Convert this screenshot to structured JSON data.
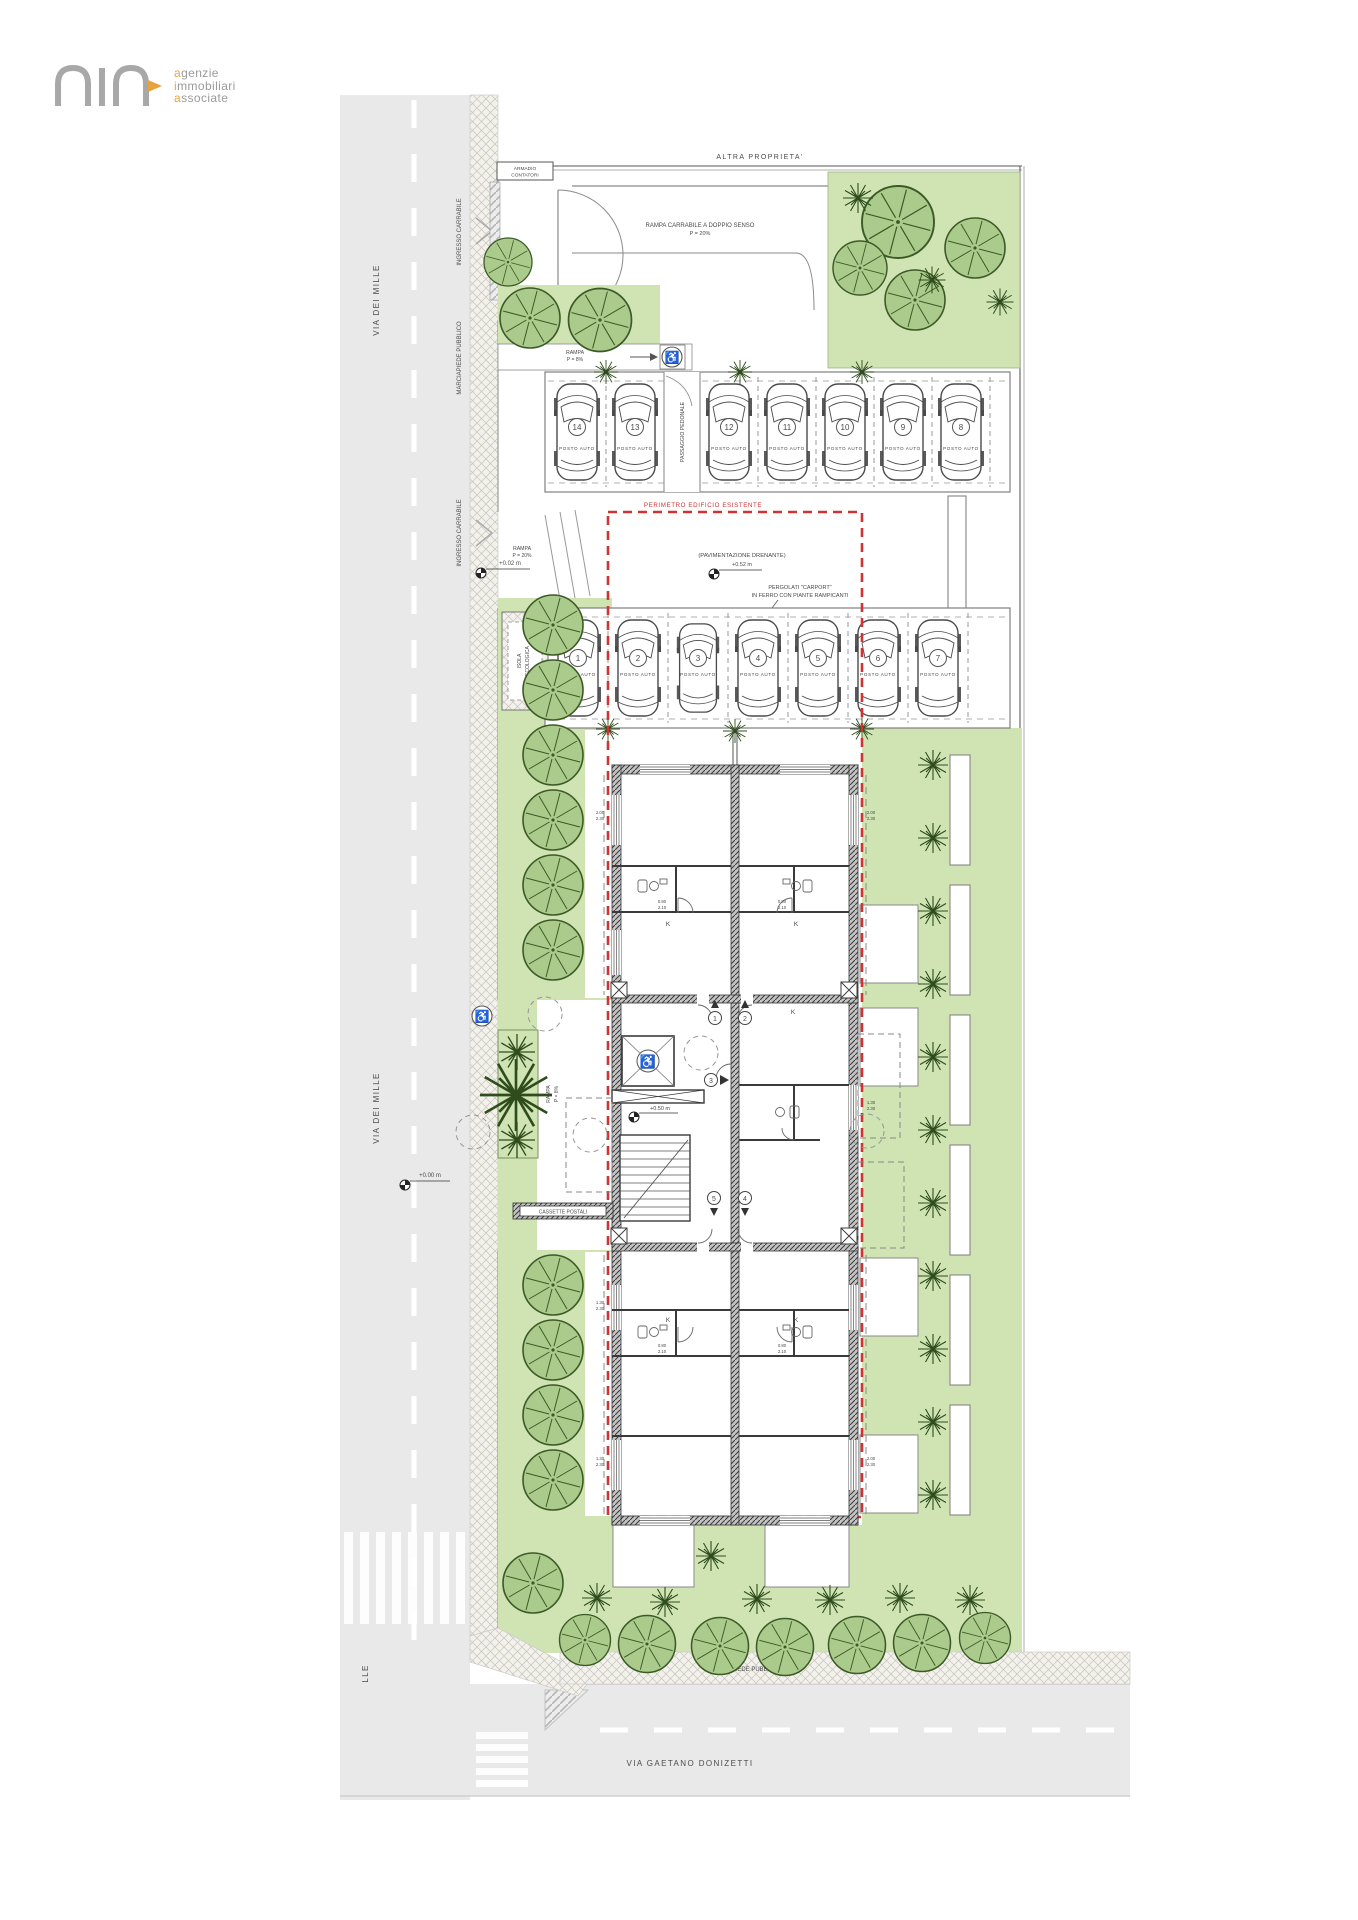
{
  "logo": {
    "accents": [
      "a",
      "i",
      "a"
    ],
    "rests": [
      "genzie",
      "mmobiliari",
      "ssociate"
    ]
  },
  "icons": {
    "wheelchair": "♿"
  },
  "labels": {
    "altra_top": "ALTRA PROPRIETA'",
    "altra_right": "ALTRA PROPRIETA'",
    "armadio_1": "ARMADIO",
    "armadio_2": "CONTATORI",
    "rampa_carrabile": "RAMPA CARRABILE A DOPPIO SENSO",
    "rampa": "RAMPA",
    "rampa_p20": "P = 20%",
    "rampa_p8": "P = 8%",
    "ingresso_carrabile": "INGRESSO CARRABILE",
    "marciapiede": "MARCIAPIEDE PUBBLICO",
    "via_mille": "VIA DEI MILLE",
    "via_donizetti": "VIA GAETANO DONIZETTI",
    "passaggio": "PASSAGGIO PEDONALE",
    "perimetro": "PERIMETRO EDIFICIO ESISTENTE",
    "pavimentazione": "(PAVIMENTAZIONE DRENANTE)",
    "pergolati_1": "PERGOLATI \"CARPORT\"",
    "pergolati_2": "IN FERRO CON PIANTE RAMPICANTI",
    "isola_1": "ISOLA",
    "isola_2": "ECOLOGICA",
    "cassette": "CASSETTE POSTALI",
    "kitchen": "K"
  },
  "parking": {
    "upper": [
      "14",
      "13",
      "12",
      "11",
      "10",
      "9",
      "8"
    ],
    "lower": [
      "1",
      "2",
      "3",
      "4",
      "5",
      "6",
      "7"
    ],
    "spot_label": "POSTO AUTO"
  },
  "entrances": [
    "1",
    "2",
    "3",
    "4",
    "5"
  ],
  "levels": {
    "street": "+0.00 m",
    "sidewalk": "+0.02 m",
    "court": "+0.52 m",
    "entrance": "+0.50 m"
  },
  "dims": {
    "win_w": "2.00",
    "win_h": "2.30",
    "win2_w": "1.30",
    "win2_h": "2.30",
    "bath_w": "0.80",
    "bath_h": "2.10"
  },
  "colors": {
    "lawn": "#cfe3b3",
    "tree": "#a9c98b",
    "street": "#e9e9e9",
    "red_perimeter": "#cf3333",
    "accent_orange": "#e8a33d"
  }
}
